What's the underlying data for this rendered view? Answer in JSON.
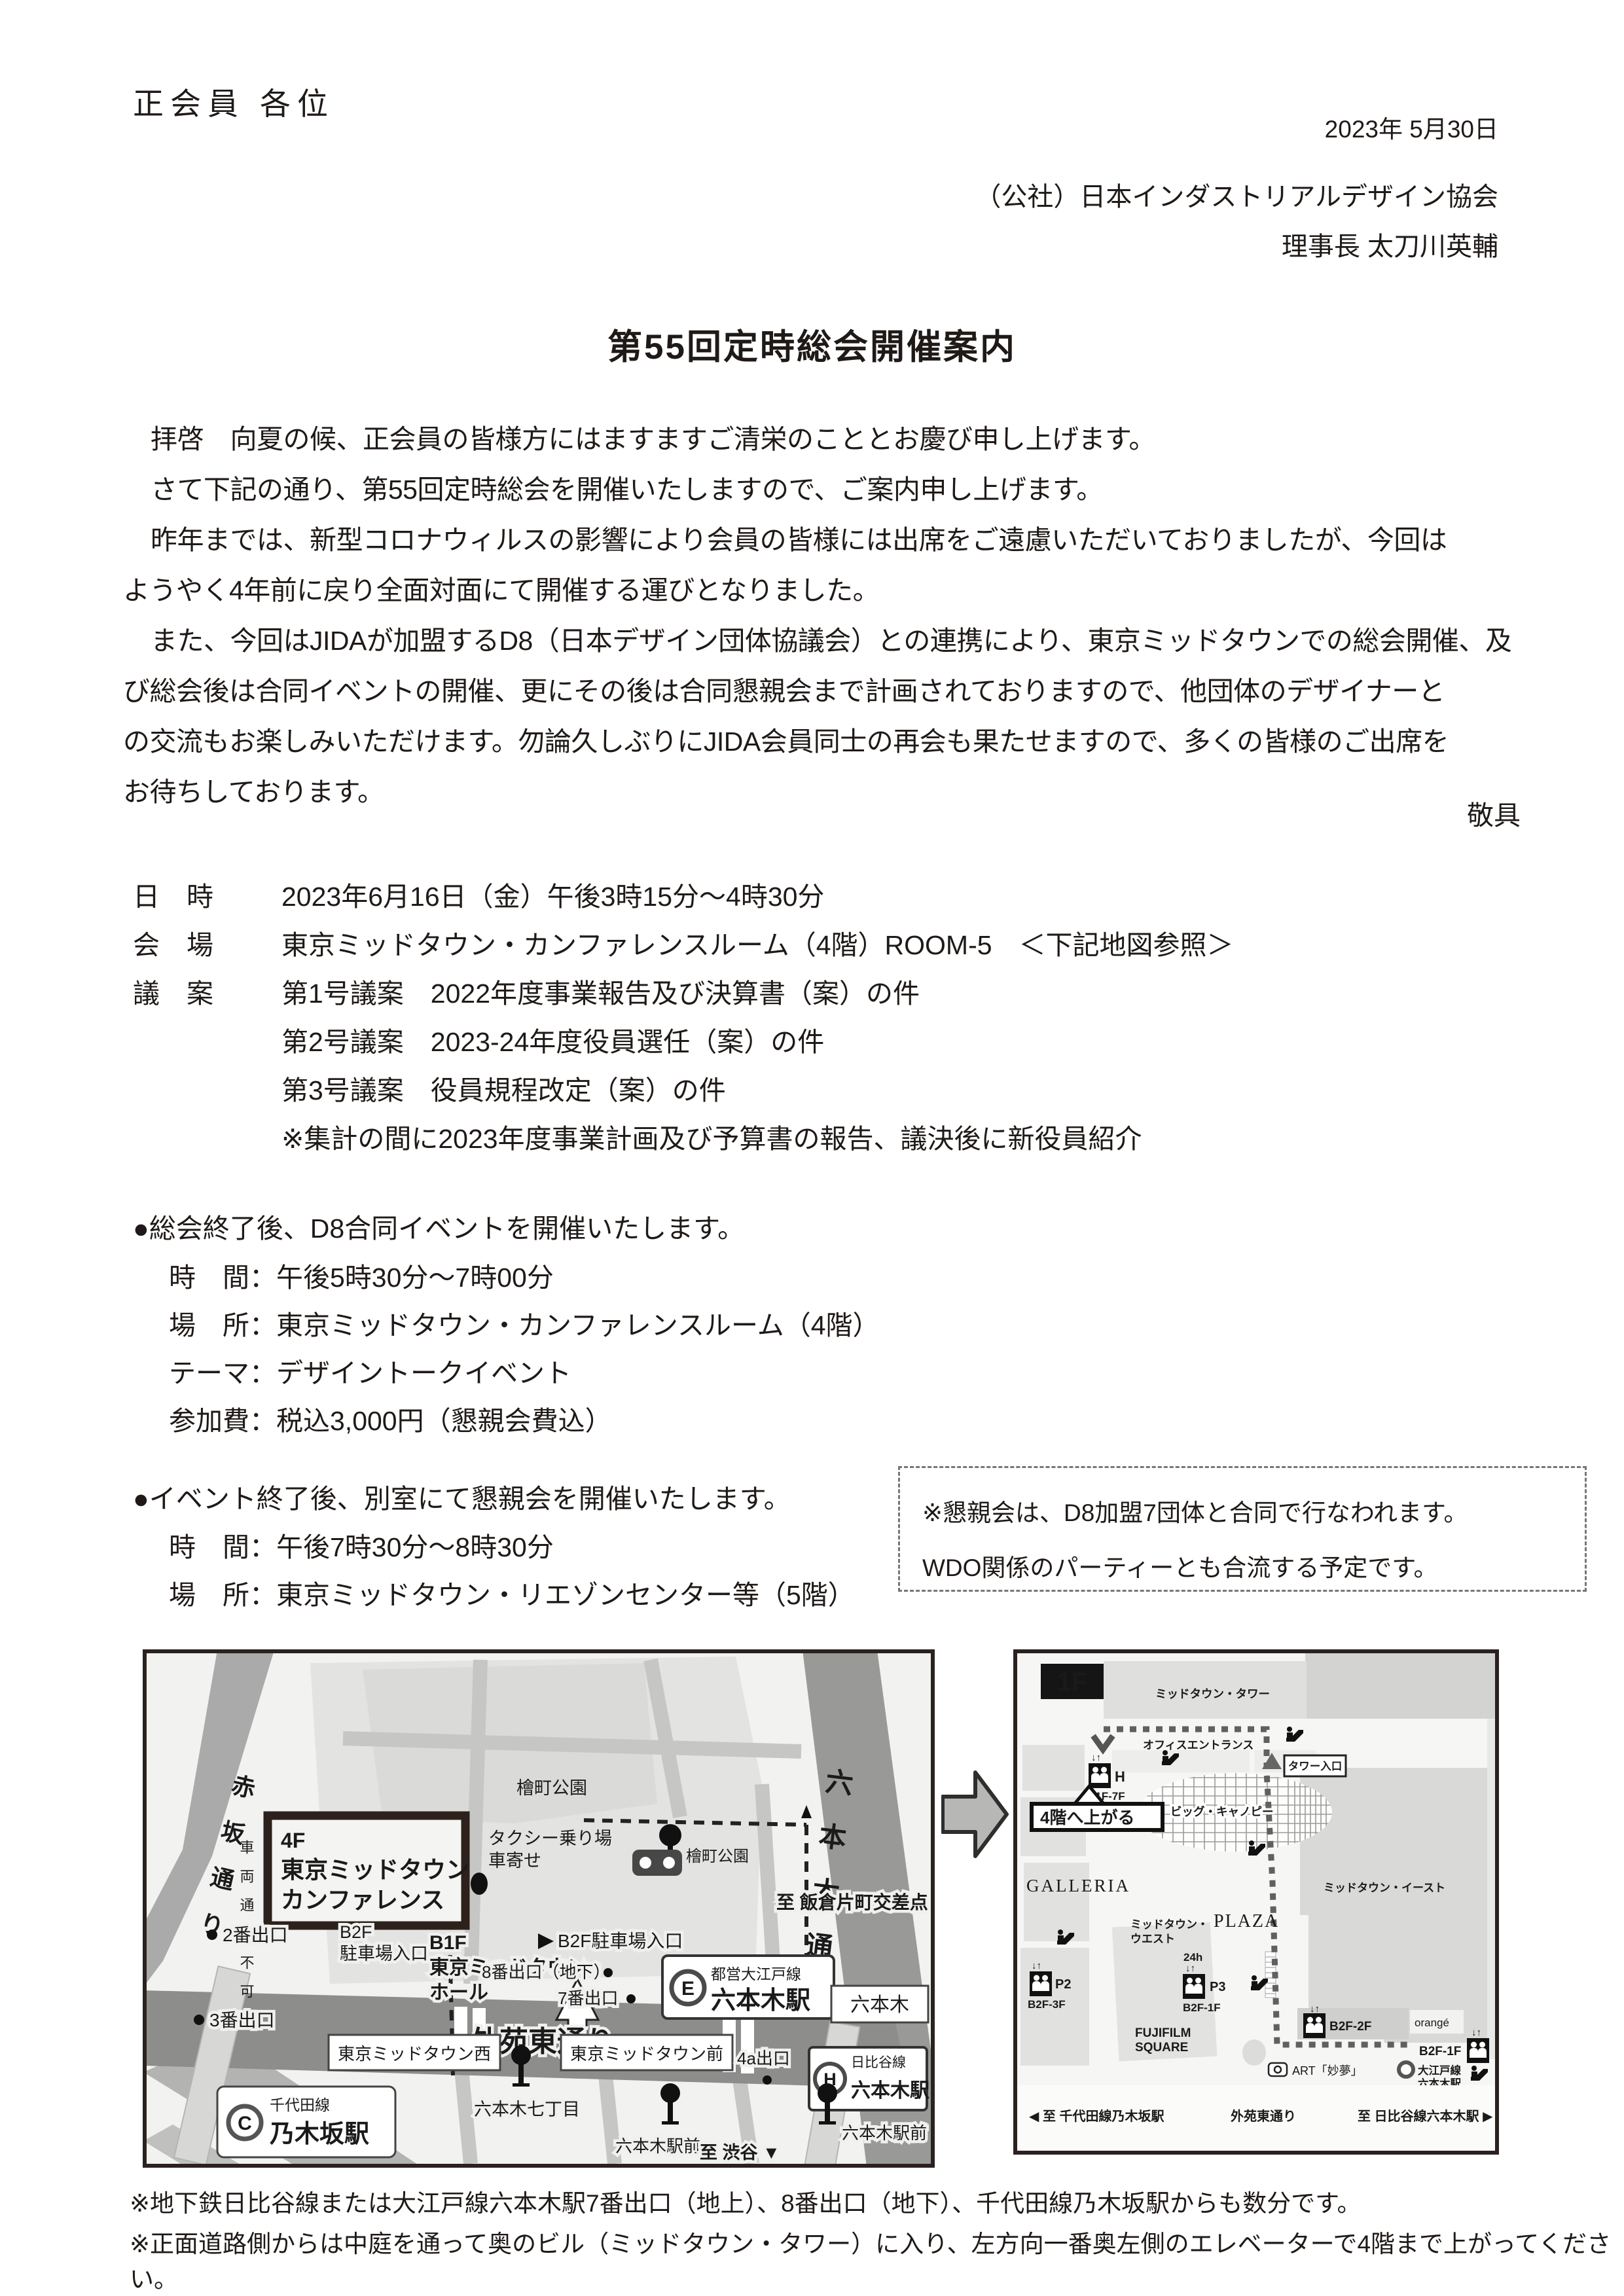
{
  "header": {
    "recipient": "正会員 各位",
    "date": "2023年 5月30日",
    "org": "（公社）日本インダストリアルデザイン協会",
    "signer": "理事長 太刀川英輔"
  },
  "title": "第55回定時総会開催案内",
  "body": {
    "p1": "拝啓　向夏の候、正会員の皆様方にはますますご清栄のこととお慶び申し上げます。",
    "p2": "さて下記の通り、第55回定時総会を開催いたしますので、ご案内申し上げます。",
    "p3": "昨年までは、新型コロナウィルスの影響により会員の皆様には出席をご遠慮いただいておりましたが、今回は",
    "p4": "ようやく4年前に戻り全面対面にて開催する運びとなりました。",
    "p5": "また、今回はJIDAが加盟するD8（日本デザイン団体協議会）との連携により、東京ミッドタウンでの総会開催、及",
    "p6": "び総会後は合同イベントの開催、更にその後は合同懇親会まで計画されておりますので、他団体のデザイナーと",
    "p7": "の交流もお楽しみいただけます。勿論久しぶりにJIDA会員同士の再会も果たせますので、多くの皆様のご出席を",
    "p8": "お待ちしております。",
    "closing": "敬具"
  },
  "meeting": {
    "rows": [
      {
        "label": "日　時",
        "value": "2023年6月16日（金）午後3時15分～4時30分"
      },
      {
        "label": "会　場",
        "value": "東京ミッドタウン・カンファレンスルーム（4階）ROOM-5　＜下記地図参照＞"
      },
      {
        "label": "議　案",
        "value": "第1号議案　2022年度事業報告及び決算書（案）の件"
      },
      {
        "label": "",
        "value": "第2号議案　2023-24年度役員選任（案）の件"
      },
      {
        "label": "",
        "value": "第3号議案　役員規程改定（案）の件"
      },
      {
        "label": "",
        "value": "※集計の間に2023年度事業計画及び予算書の報告、議決後に新役員紹介"
      }
    ]
  },
  "event1": {
    "heading": "●総会終了後、D8合同イベントを開催いたします。",
    "rows": [
      {
        "label": "時　間：",
        "value": "午後5時30分～7時00分"
      },
      {
        "label": "場　所：",
        "value": "東京ミッドタウン・カンファレンスルーム（4階）"
      },
      {
        "label": "テーマ：",
        "value": "デザイントークイベント"
      },
      {
        "label": "参加費：",
        "value": "税込3,000円（懇親会費込）"
      }
    ]
  },
  "event2": {
    "heading": "●イベント終了後、別室にて懇親会を開催いたします。",
    "rows": [
      {
        "label": "時　間：",
        "value": "午後7時30分～8時30分"
      },
      {
        "label": "場　所：",
        "value": "東京ミッドタウン・リエゾンセンター等（5階）"
      }
    ]
  },
  "notice": {
    "line1": "※懇親会は、D8加盟7団体と合同で行なわれます。",
    "line2": "WDO関係のパーティーとも合流する予定です。"
  },
  "maps": {
    "left": {
      "labels": {
        "akasaka": "赤坂通り",
        "roppongi_dori": "六本木通り",
        "gaien": "外苑東通り",
        "park": "檜町公園",
        "conf1": "4F",
        "conf2": "東京ミッドタウン",
        "conf3": "カンファレンス",
        "taxi": "タクシー乗り場",
        "kuruma": "車寄せ",
        "b2f_parking": "B2F駐車場入口",
        "no_vehicles": "車両通行不可",
        "exit2": "2番出口",
        "exit3": "3番出口",
        "hall1": "B1F",
        "hall2": "東京ミッドタウン・",
        "hall3": "ホール",
        "b2f": "B2F",
        "parking_entrance": "駐車場入口",
        "exit8": "8番出口（地下）",
        "exit7": "7番出口",
        "oedo_line": "都営大江戸線",
        "roppongi_sta": "六本木駅",
        "e": "E",
        "mid_west": "東京ミッドタウン西",
        "mid_front": "東京ミッドタウン前",
        "roppongi": "六本木",
        "exit4a": "4a出口",
        "hibiya_line": "日比谷線",
        "h": "H",
        "nanachome": "六本木七丁目",
        "chiyoda_line": "千代田線",
        "nogizaka": "乃木坂駅",
        "c": "C",
        "ekimae": "六本木駅前",
        "to_shibuya": "至 渋谷 ▼",
        "to_iigura": "至 飯倉片町交差点 ▶"
      }
    },
    "right": {
      "labels": {
        "floor": "1F",
        "tower": "ミッドタウン・タワー",
        "office": "オフィスエントランス",
        "tower_gate": "タワー入口",
        "h": "H",
        "h_floors": "B1F-7F",
        "go4f": "4階へ上がる",
        "canopy": "ビッグ・キャノピー",
        "galleria": "GALLERIA",
        "east": "ミッドタウン・イースト",
        "west1": "ミッドタウン・",
        "west2": "ウエスト",
        "plaza": "PLAZA",
        "h24": "24h",
        "p2": "P2",
        "p2f": "B2F-3F",
        "p3": "P3",
        "p3f": "B2F-1F",
        "fuji1": "FUJIFILM",
        "fuji2": "SQUARE",
        "b2f2f": "B2F-2F",
        "orange": "orangé",
        "b2f1f": "B2F-1F",
        "art": "ART「妙夢」",
        "oedo": "大江戸線",
        "roppongi_sta": "六本木駅",
        "to_nogizaka": "◀ 至 千代田線乃木坂駅",
        "gaien": "外苑東通り",
        "to_roppongi": "至 日比谷線六本木駅 ▶",
        "updown": "↓↑"
      }
    }
  },
  "footnotes": {
    "line1": "※地下鉄日比谷線または大江戸線六本木駅7番出口（地上）、8番出口（地下）、千代田線乃木坂駅からも数分です。",
    "line2": "※正面道路側からは中庭を通って奥のビル（ミッドタウン・タワー）に入り、左方向一番奥左側のエレベーターで4階まで上がってください。"
  }
}
